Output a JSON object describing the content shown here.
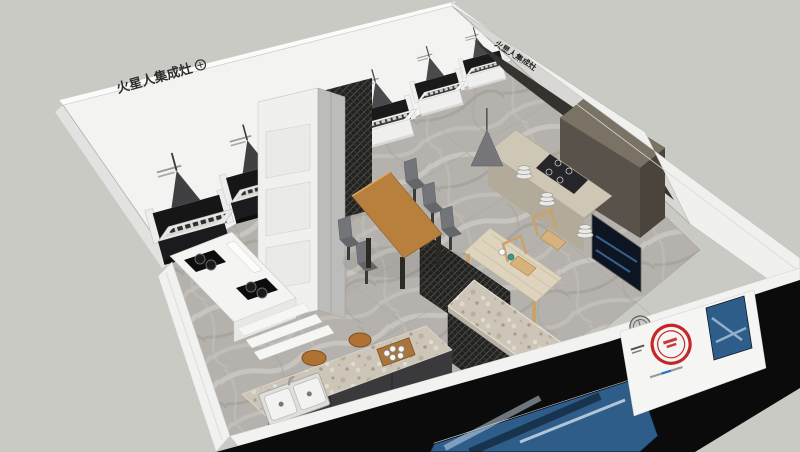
{
  "brand": {
    "name": "火星人集成灶"
  },
  "signs": {
    "left_wall_brand": "火星人集成灶",
    "back_wall_brand_1": "火星人集成灶",
    "back_wall_brand_2": "火星人集成灶",
    "front_wall_brand_3d": "火星人 集成灶"
  },
  "colors": {
    "background": "#c9cac4",
    "wall_white": "#f3f3f1",
    "wall_dark_panel": "#35332f",
    "front_wall_black": "#0b0b0b",
    "floor_marble": "#b6b3ae",
    "wood_table": "#b97f3c",
    "seal_red": "#c42727",
    "poster_blue": "#2f5d8a",
    "counter_beige": "#cfc7b5",
    "stool_wood": "#b07232"
  }
}
